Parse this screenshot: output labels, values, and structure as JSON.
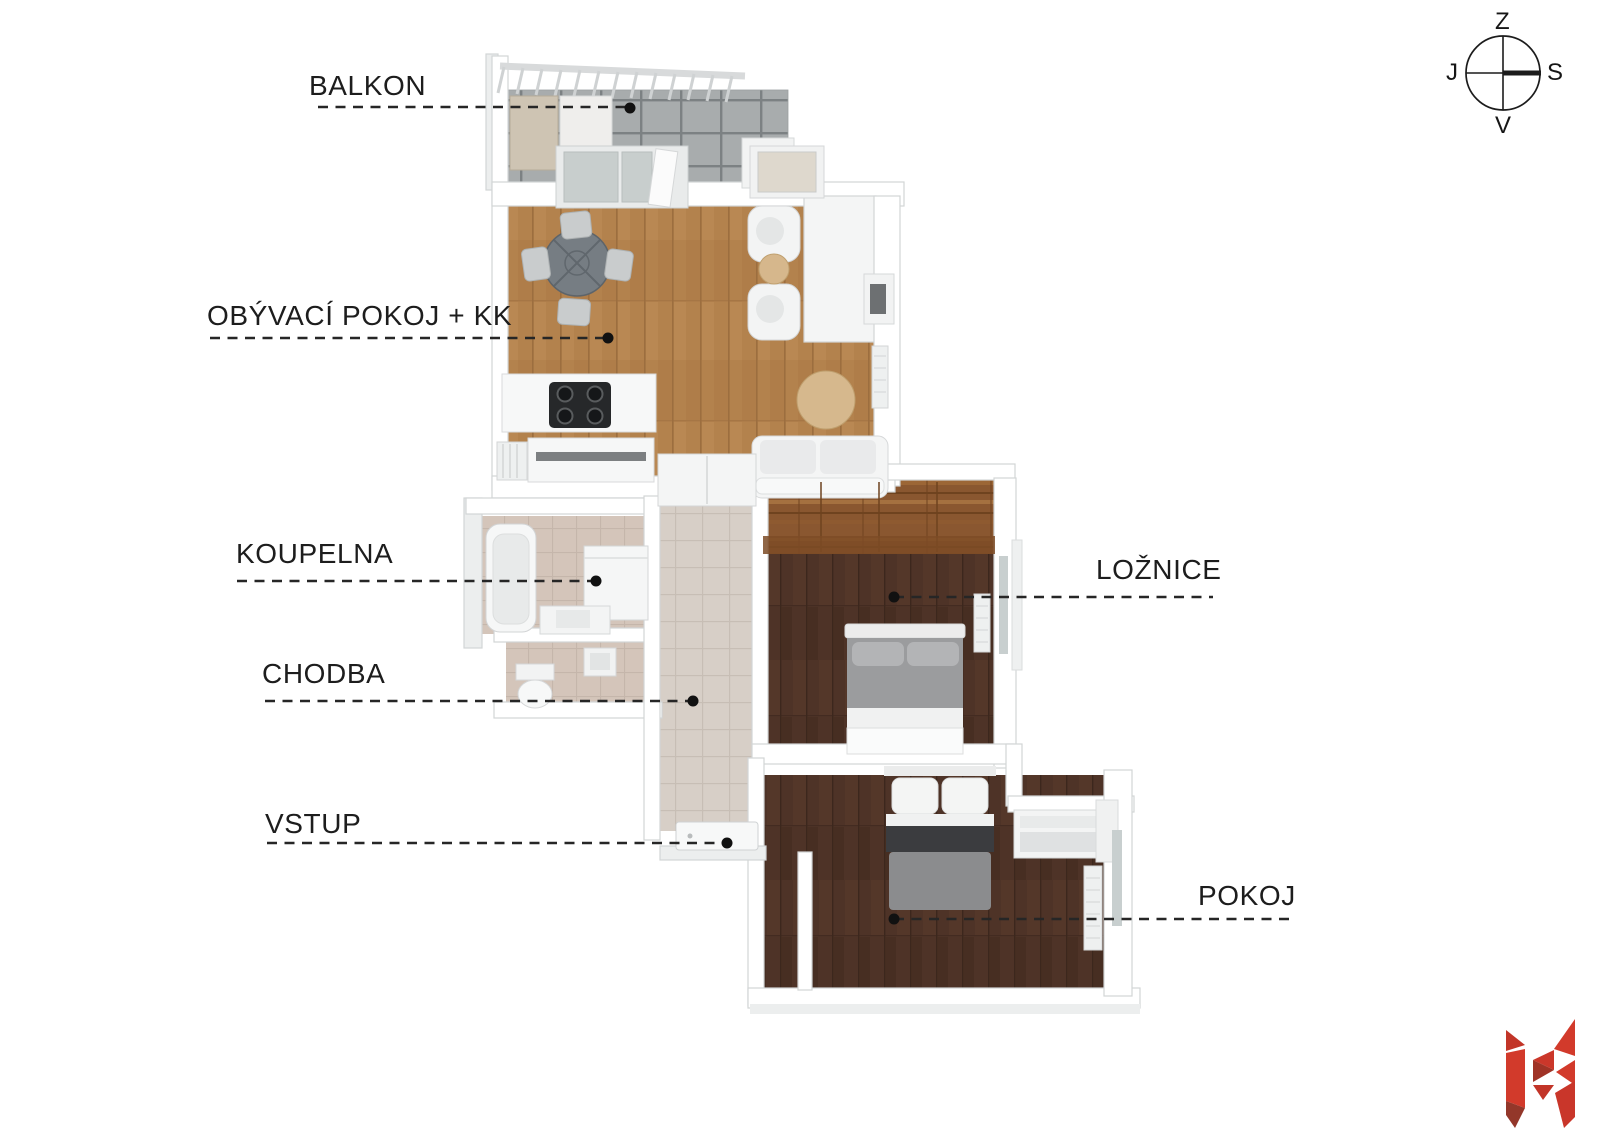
{
  "diagram_title": "apartment-floor-plan",
  "rooms": [
    {
      "id": "balkon",
      "label": "BALKON"
    },
    {
      "id": "obyvaci",
      "label": "OBÝVACÍ POKOJ + KK"
    },
    {
      "id": "koupelna",
      "label": "KOUPELNA"
    },
    {
      "id": "chodba",
      "label": "CHODBA"
    },
    {
      "id": "vstup",
      "label": "VSTUP"
    },
    {
      "id": "loznice",
      "label": "LOŽNICE"
    },
    {
      "id": "pokoj",
      "label": "POKOJ"
    }
  ],
  "compass": {
    "top": "Z",
    "right": "S",
    "bottom": "V",
    "left": "J"
  },
  "colors": {
    "accent_red": "#d23a2b",
    "accent_red_dark": "#93372a",
    "label_text": "#1d1d1d",
    "wood_light": "#b3824d",
    "wood_dark": "#4e3327",
    "wardrobe_wood": "#8a5730",
    "balcony_tile": "#a8acad",
    "corridor_tile": "#d7cfc7",
    "bath_tile": "#d4c5ba",
    "wall": "#ffffff"
  }
}
